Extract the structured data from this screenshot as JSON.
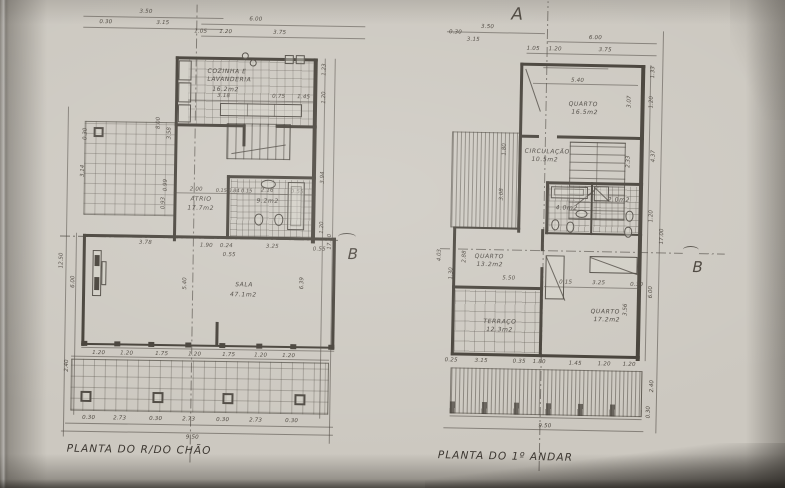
{
  "colors": {
    "paper": "#cdc9c2",
    "ink": "#4a453e",
    "wall": "#413c35"
  },
  "markers": {
    "a": "A",
    "b_left": "B",
    "b_right": "B"
  },
  "lp": {
    "title": "PLANTA DO R/DO CHÃO",
    "rooms": {
      "cozinha1": "COZINHA E",
      "cozinha2": "LAVANDERIA",
      "cozinha_area": "16.2m2",
      "atrio": "ATRIO",
      "atrio_area": "17.7m2",
      "wc_area": "9.2m2",
      "sala": "SALA",
      "sala_area": "47.1m2"
    },
    "d": {
      "t0": "3.50",
      "t1": "0.30",
      "t2": "3.15",
      "t3": "6.00",
      "t4": "1.05",
      "t5": "1.20",
      "t6": "3.75",
      "k0": "3.18",
      "k1": "0.75",
      "k2": "1.45",
      "m0": "2.00",
      "m1": "0.15 0.84 0.15",
      "m2": "2.16",
      "m3": "0.55",
      "s0": "3.78",
      "s1": "1.90",
      "s2": "0.24",
      "s3": "0.55",
      "s4": "3.25",
      "s5": "0.55",
      "s6": "5.40",
      "s7": "6.39",
      "b0": "1.20",
      "b1": "1.20",
      "b2": "1.75",
      "b3": "1.20",
      "b4": "1.75",
      "b5": "1.20",
      "b6": "1.20",
      "c0": "0.30",
      "c1": "2.73",
      "c2": "0.30",
      "c3": "2.73",
      "c4": "0.30",
      "c5": "2.73",
      "c6": "0.30",
      "tot": "9.50",
      "l0": "12.50",
      "l1": "6.00",
      "l2": "2.40",
      "l3": "3.14",
      "l4": "0.30",
      "l5": "8.00",
      "l6": "3.58",
      "l7": "0.99",
      "l8": "0.93",
      "r0": "1.23",
      "r1": "1.20",
      "r2": "3.94",
      "r3": "1.20",
      "r4": "17.00"
    }
  },
  "rp": {
    "title": "PLANTA DO 1º ANDAR",
    "rooms": {
      "quarto1": "QUARTO",
      "quarto1_area": "16.5m2",
      "circ": "CIRCULAÇÃO",
      "circ_area": "10.5m2",
      "quarto2": "QUARTO",
      "quarto2_area": "13.2m2",
      "quarto3": "QUARTO",
      "quarto3_area": "17.2m2",
      "terraco": "TERRAÇO",
      "terraco_area": "12.3m2",
      "wc1_area": "4.0m2",
      "wc2_area": "2.0m2"
    },
    "d": {
      "t0": "3.50",
      "t1": "0.30",
      "t2": "3.15",
      "t3": "6.00",
      "t4": "1.05",
      "t5": "1.20",
      "t6": "3.75",
      "i0": "5.40",
      "l0": "4.03",
      "l1": "2.88",
      "l2": "1.30",
      "l3": "1.80",
      "l4": "3.08",
      "l5": "5.50",
      "m0": "0.15",
      "m1": "3.25",
      "m2": "0.30",
      "b0": "0.25",
      "b1": "3.15",
      "b2": "0.35",
      "b3": "1.80",
      "b4": "1.45",
      "b5": "1.20",
      "b6": "1.20",
      "tot": "9.50",
      "r0": "1.33",
      "r1": "1.20",
      "r2": "3.07",
      "r3": "2.33",
      "r4": "4.37",
      "r5": "1.20",
      "r6": "17.00",
      "r7": "6.00",
      "r8": "3.56",
      "r9": "2.40",
      "r10": "0.30"
    }
  }
}
